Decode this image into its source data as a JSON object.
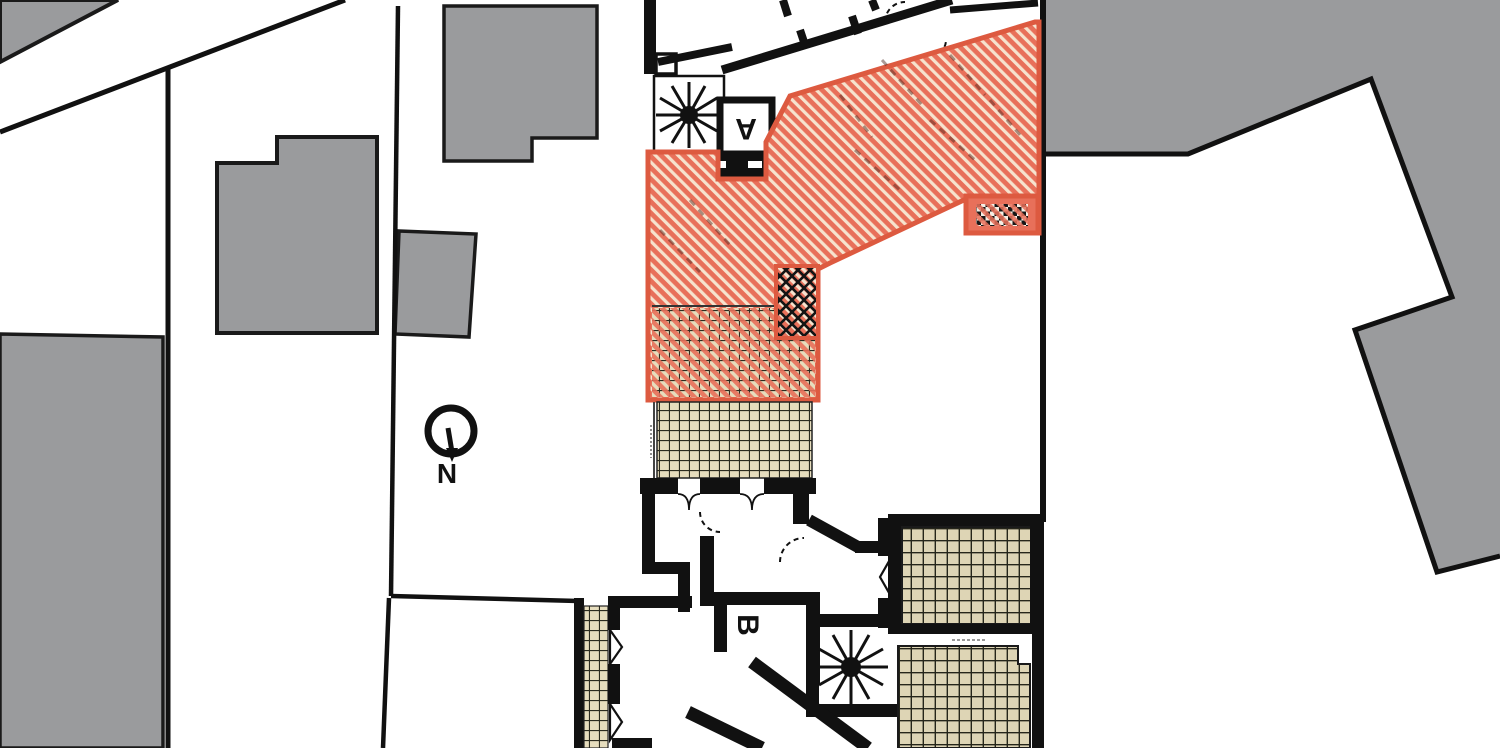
{
  "document": {
    "type": "architectural-site-floor-plan",
    "description": "Black-and-white floor plan with one dwelling unit highlighted in orange hatch, tiled terraces, neighbouring buildings in grey"
  },
  "labels": {
    "stair_core_a": "A",
    "stair_core_b": "B",
    "north": "N"
  },
  "colors": {
    "highlight_fill": "#E8705A",
    "highlight_stripe": "#F6E3CE",
    "highlight_border": "#DD5A40",
    "neighbor_building": "#9A9B9D",
    "wall": "#111111",
    "tile_fill": "#E6DDBD",
    "tile_grid": "#2B2B1E",
    "background": "#FFFFFF"
  },
  "features": {
    "north_arrow": "circle with needle pointing to N below",
    "spiral_stairs": 2,
    "hatched_unit_zones": [
      "diagonal-stripe main area",
      "cross-hatch void",
      "tile terrace with stripe overlay",
      "checker strip with stripe overlay"
    ],
    "tiled_terraces": 4
  }
}
